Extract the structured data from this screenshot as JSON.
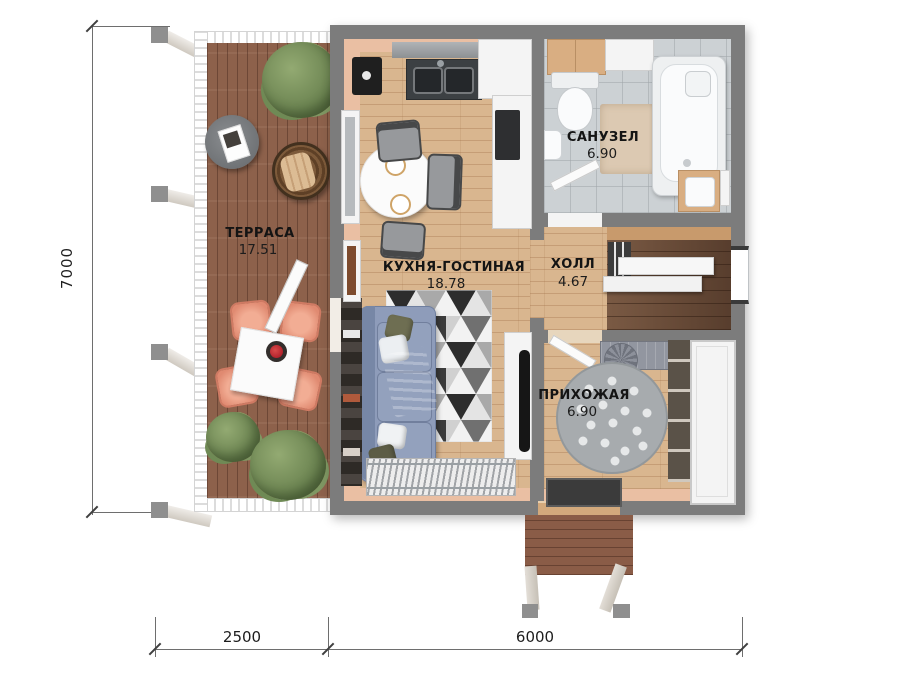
{
  "rooms": {
    "terrace": {
      "name": "ТЕРРАСА",
      "area": "17.51"
    },
    "kitchen_living": {
      "name": "КУХНЯ-ГОСТИНАЯ",
      "area": "18.78"
    },
    "bathroom": {
      "name": "САНУЗЕЛ",
      "area": "6.90"
    },
    "hall": {
      "name": "ХОЛЛ",
      "area": "4.67"
    },
    "entry": {
      "name": "ПРИХОЖАЯ",
      "area": "6.90"
    }
  },
  "dimensions": {
    "left": "7000",
    "bottom_segment_1": "2500",
    "bottom_segment_2": "6000"
  },
  "colors": {
    "wall": "#7c7c7c",
    "terrace_deck": "#8d614b",
    "interior_floor": "#d9b68f",
    "bathroom_floor": "#ccd1d4",
    "accent_peach": "#eabfa3",
    "sofa": "#8e9cba",
    "terrace_chair": "#e59079"
  }
}
